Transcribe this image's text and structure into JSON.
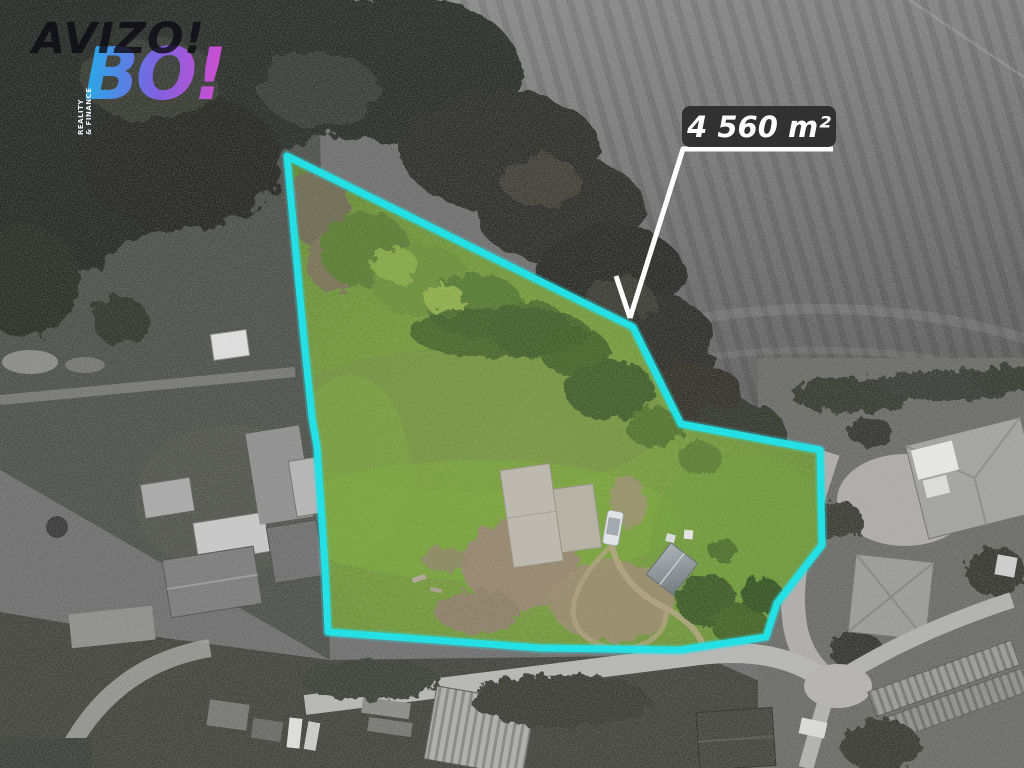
{
  "logo": {
    "brand_top": "AVIZO!",
    "brand_main": "BO!",
    "brand_sub_line1": "REALITY",
    "brand_sub_line2": "& FINANCE"
  },
  "annotation": {
    "area_label": "4 560 m²"
  },
  "plot": {
    "outline_points": "287,156 633,327 681,424 820,450 822,545 777,603 766,637 680,650 540,648 328,632 325,567 317,447 312,418 303,330",
    "outline_color": "#14e3e8",
    "outline_width": "7"
  },
  "palette": {
    "label_bg": "#2d2d2d",
    "label_text": "#ffffff",
    "arrow": "#ffffff",
    "logo_blue": "#2ba7e8",
    "logo_purple": "#cc4fd0",
    "grass_base": "#6f9638",
    "field_gray": "#7b7b7b",
    "forest_dark": "#2b2d28"
  }
}
